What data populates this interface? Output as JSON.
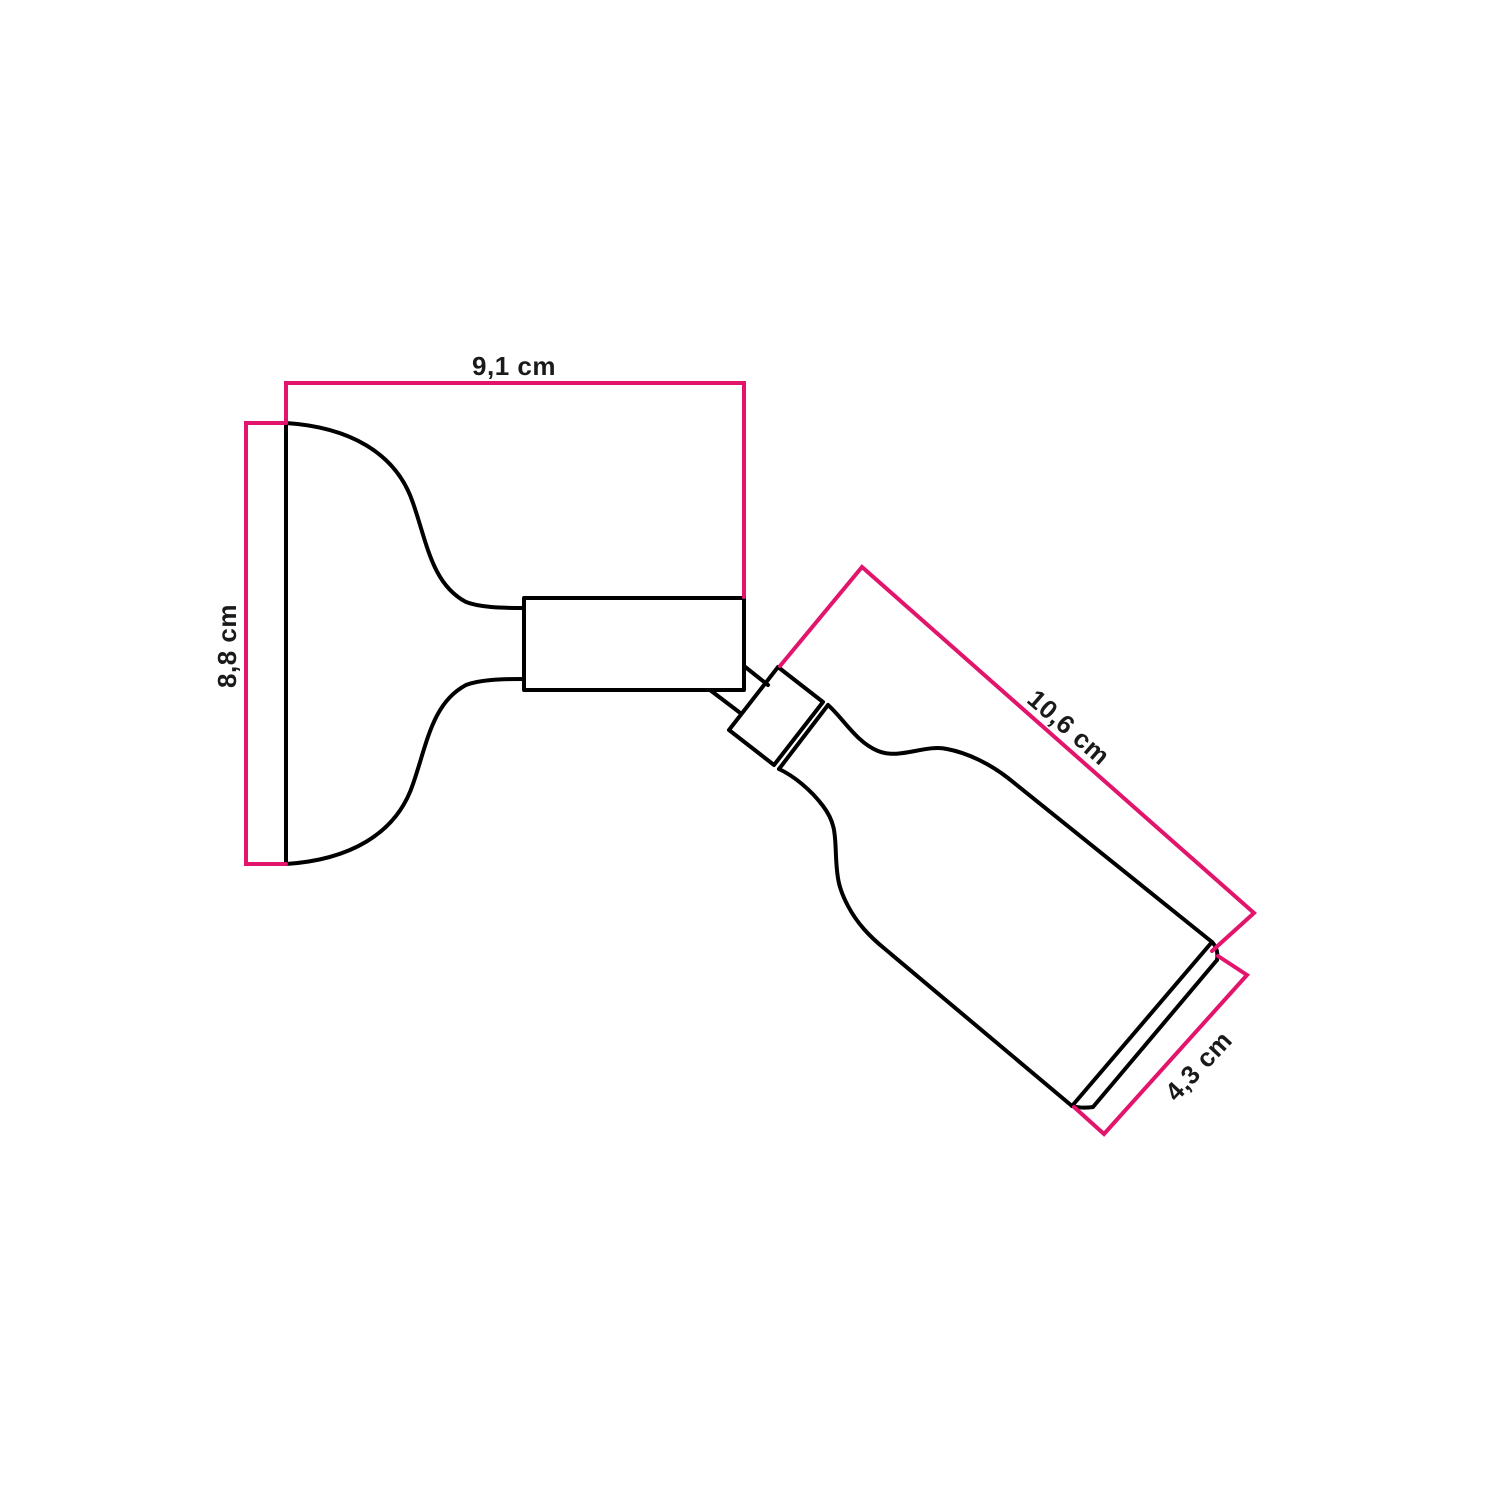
{
  "colors": {
    "outline": "#000000",
    "accent": "#e2146c",
    "label": "#1a1a1a",
    "background": "#ffffff"
  },
  "dimensions": {
    "mount_width": "9,1 cm",
    "mount_height": "8,8 cm",
    "spot_length": "10,6 cm",
    "spot_diameter": "4,3 cm"
  }
}
